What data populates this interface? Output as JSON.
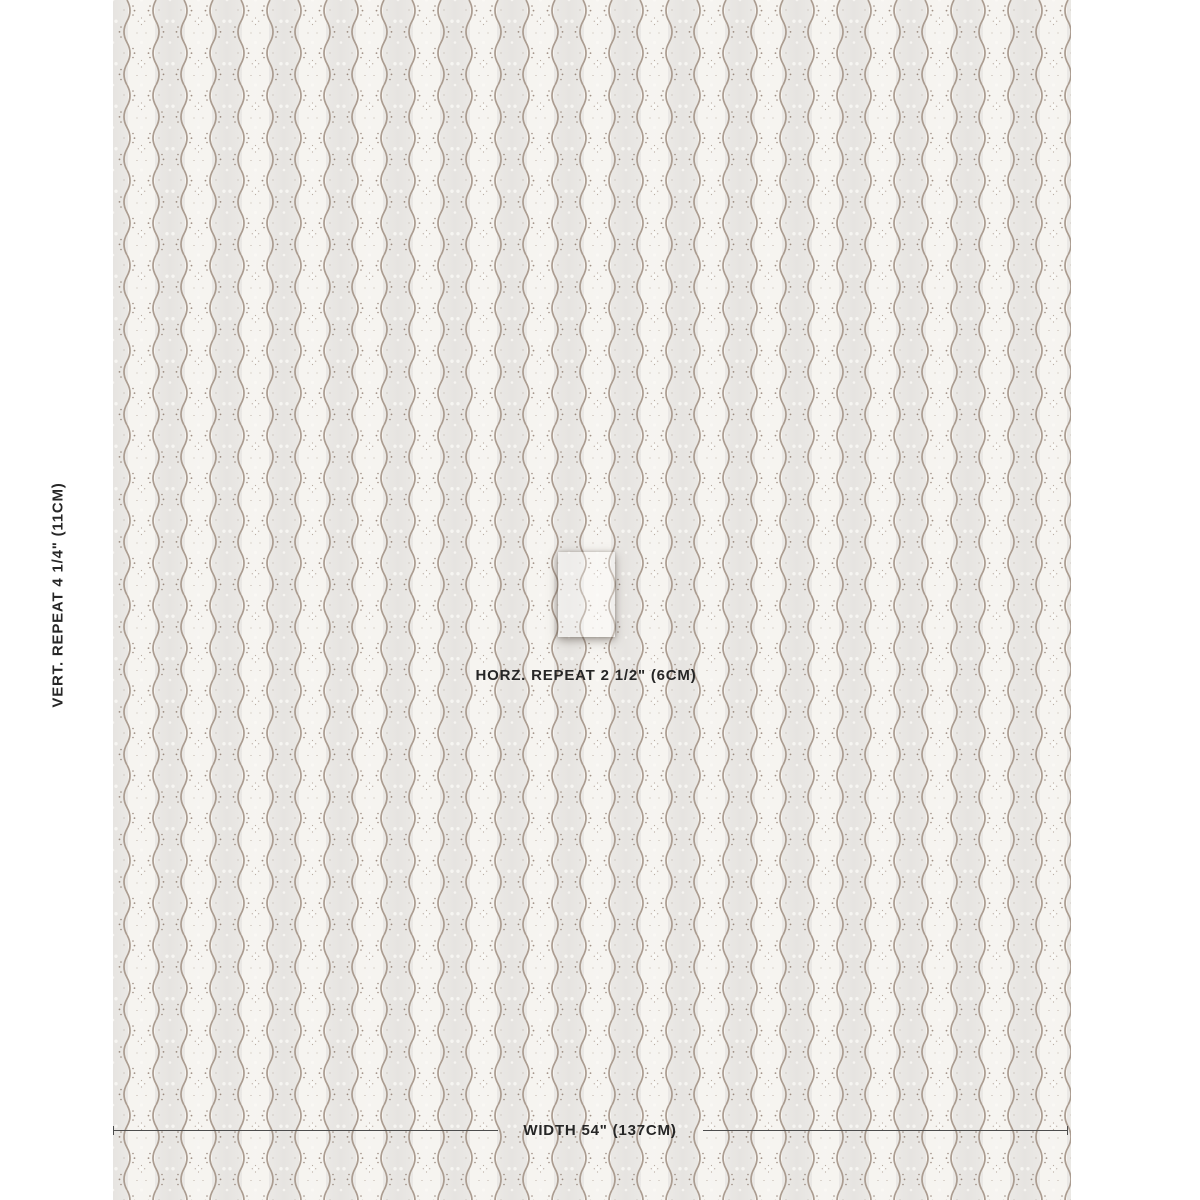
{
  "annotations": {
    "vertical_repeat_label": "VERT. REPEAT 4 1/4\" (11CM)",
    "horizontal_repeat_label": "HORZ. REPEAT 2 1/2\" (6CM)",
    "width_label": "WIDTH 54\" (137CM)"
  },
  "swatch": {
    "description": "Fabric swatch with vertical scalloped wavy stripes, dotted flanking curves and floret dot motifs; one horizontal repeat highlighted in the center",
    "colors": {
      "fabric_base": "#EBE9E6",
      "light_band": "#F6F4F0",
      "wave_line": "#AB9C90",
      "dot_dark": "#9C8C81",
      "dot_light": "#FBFAF7",
      "text": "#262626",
      "dimension_line": "#4D4D4D"
    }
  }
}
